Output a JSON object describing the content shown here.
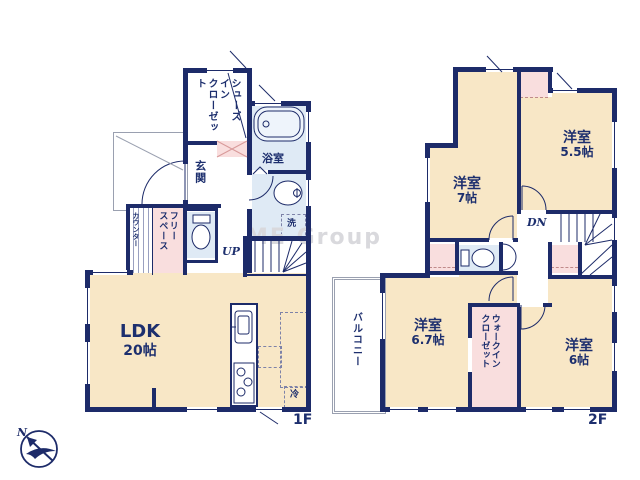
{
  "watermark": "ME Group",
  "compass": {
    "north": "N"
  },
  "floor1": {
    "floor_label": "1F",
    "ldk": {
      "name": "LDK",
      "size": "20帖"
    },
    "shoes_closet_lines": [
      "シューズ",
      "イン",
      "クローゼット"
    ],
    "genkan": "玄関",
    "bathroom": "浴室",
    "laundry": "洗",
    "counter": "カウンター",
    "free_space_lines": [
      "フリー",
      "スペース"
    ],
    "fridge": "冷",
    "stairs": "UP"
  },
  "floor2": {
    "floor_label": "2F",
    "bedroom_7": {
      "name": "洋室",
      "size": "7帖"
    },
    "bedroom_5_5": {
      "name": "洋室",
      "size": "5.5帖"
    },
    "bedroom_6_7": {
      "name": "洋室",
      "size": "6.7帖"
    },
    "bedroom_6": {
      "name": "洋室",
      "size": "6帖"
    },
    "wic_lines": [
      "ウォークイン",
      "クローゼット"
    ],
    "balcony": "バルコニー",
    "stairs": "DN"
  },
  "colors": {
    "wall": "#1d2b69",
    "room": "#f8e7c6",
    "closet": "#f9dede",
    "wet": "#dfeaf5"
  }
}
